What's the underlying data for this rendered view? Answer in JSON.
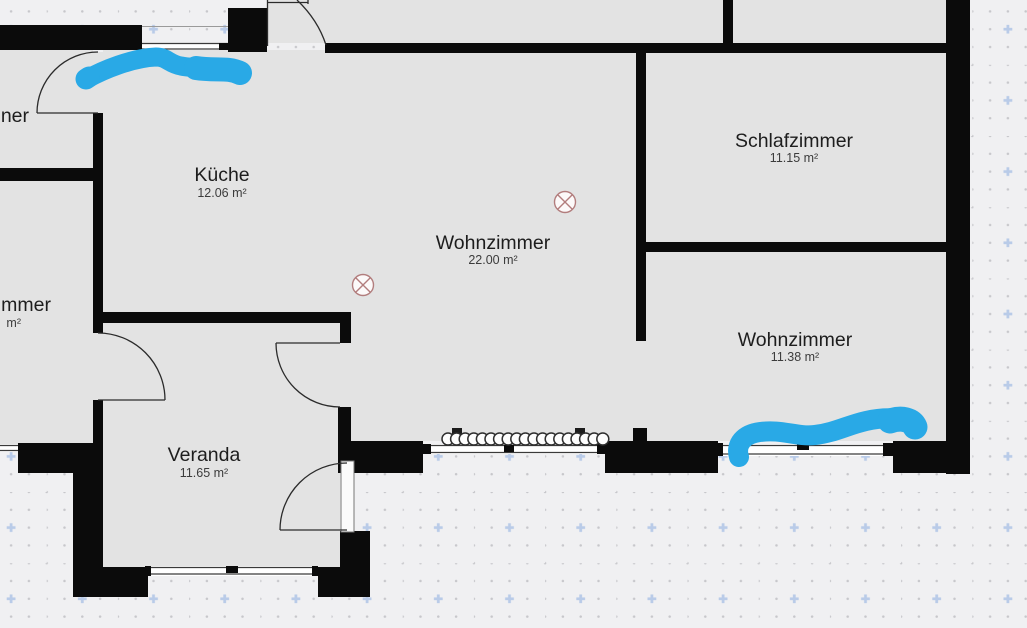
{
  "palette": {
    "background": "#f0f0f2",
    "room_fill": "#e3e3e3",
    "wall_color": "#0b0b0b",
    "window_line_color": "#3a3a3a",
    "door_line_color": "#2b2b2b",
    "grid_dot_color": "#c7c7cb",
    "grid_plus_color": "#b9cbe8",
    "annotation_color": "#29a9e6",
    "symbol_color": "#b27d7d"
  },
  "rooms": [
    {
      "id": "kueche",
      "name": "Küche",
      "area": "12.06 m²"
    },
    {
      "id": "wohnzimmer-main",
      "name": "Wohnzimmer",
      "area": "22.00 m²"
    },
    {
      "id": "schlafzimmer",
      "name": "Schlafzimmer",
      "area": "11.15 m²"
    },
    {
      "id": "wohnzimmer-right",
      "name": "Wohnzimmer",
      "area": "11.38 m²"
    },
    {
      "id": "veranda",
      "name": "Veranda",
      "area": "11.65 m²"
    },
    {
      "id": "room-left-top-partial",
      "name": "ner",
      "area": ""
    },
    {
      "id": "room-left-bottom-partial",
      "name": "mmer",
      "area": "m²"
    }
  ],
  "symbols": [
    {
      "type": "ceiling-light"
    },
    {
      "type": "ceiling-light"
    }
  ],
  "annotations": [
    {
      "type": "marker-stroke",
      "location": "top-left-window"
    },
    {
      "type": "marker-stroke",
      "location": "bottom-right-window"
    }
  ]
}
